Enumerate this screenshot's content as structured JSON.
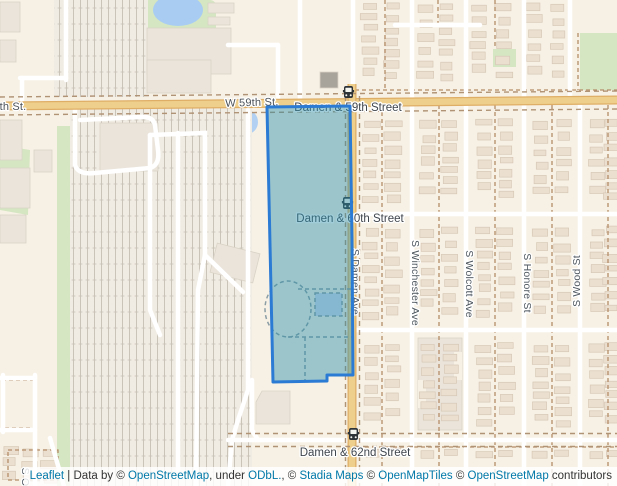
{
  "labels": {
    "w58_partial": "th St.",
    "w59": "W 59th St.",
    "s_damen": "S Damen Ave",
    "s_winchester": "S Winchester Ave",
    "s_wolcott": "S Wolcott Ave",
    "s_honore": "S Honore St",
    "s_wood": "S Wood St",
    "s_o_partial": "S O"
  },
  "stations": {
    "damen_59": "Damen & 59th Street",
    "damen_60": "Damen & 60th Street",
    "damen_62": "Damen & 62nd Street"
  },
  "overlay": {
    "points": "267,107 350,106 352,240 353,375 327,375 327,381 273,382",
    "fill": "rgba(45,145,170,0.45)",
    "stroke": "#2b7ad4"
  },
  "colors": {
    "background": "#f7f1e5",
    "road_major": "#eecf8b",
    "road_major_casing": "#dfae66",
    "road_minor": "#ffffff",
    "green": "#d5e6c2",
    "water": "#a9cdf2",
    "rail_line": "#c6bfb4",
    "building": "#ebdfd0",
    "alley_dash": "#b58d68",
    "label_text": "#4b5258",
    "link_blue": "#0078A8"
  },
  "attribution": {
    "segments": [
      {
        "t": "Leaflet",
        "link": true
      },
      {
        "t": " | Data by © ",
        "link": false
      },
      {
        "t": "OpenStreetMap",
        "link": true
      },
      {
        "t": ", under ",
        "link": false
      },
      {
        "t": "ODbL.",
        "link": true
      },
      {
        "t": ", © ",
        "link": false
      },
      {
        "t": "Stadia Maps",
        "link": true
      },
      {
        "t": " © ",
        "link": false
      },
      {
        "t": "OpenMapTiles",
        "link": true
      },
      {
        "t": " © ",
        "link": false
      },
      {
        "t": "OpenStreetMap",
        "link": true
      },
      {
        "t": " contributors",
        "link": false
      }
    ]
  }
}
